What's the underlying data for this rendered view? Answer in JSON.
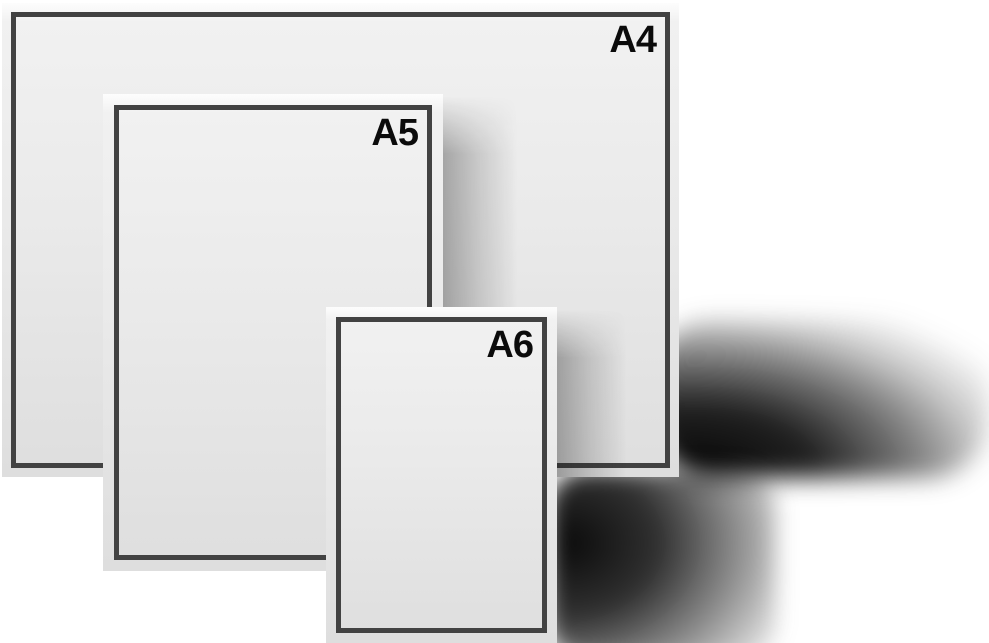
{
  "illustration": {
    "description": "Comparison of overlapping ISO paper sizes",
    "sheets": [
      {
        "id": "a4",
        "label": "A4"
      },
      {
        "id": "a5",
        "label": "A5"
      },
      {
        "id": "a6",
        "label": "A6"
      }
    ],
    "icons": {
      "paper_sheet": "framed rectangle"
    },
    "colors": {
      "background": "#ffffff",
      "paper_top": "#fdfdfd",
      "paper_bottom": "#dedede",
      "frame": "#424242",
      "label_text": "#0b0b0b",
      "wall_shadow": "#060606",
      "cast_shadow": "rgba(25,25,25,0.34)"
    }
  }
}
